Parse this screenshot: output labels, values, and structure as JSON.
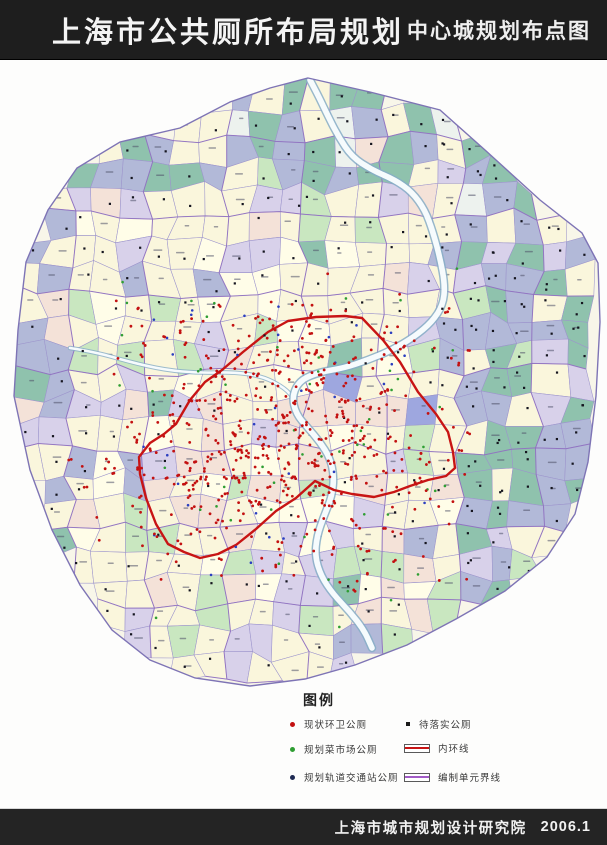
{
  "header": {
    "title": "上海市公共厕所布局规划",
    "subtitle": "中心城规划布点图"
  },
  "footer": {
    "credit": "上海市城市规划设计研究院",
    "date": "2006.1"
  },
  "legend": {
    "title": "图例",
    "items_left": [
      {
        "label": "现状环卫公厕",
        "color": "#C31111",
        "swatch": "dot"
      },
      {
        "label": "规划菜市场公厕",
        "color": "#2F9E33",
        "swatch": "dot"
      },
      {
        "label": "规划轨道交通站公厕",
        "color": "#1E2A52",
        "swatch": "dot"
      }
    ],
    "items_right": [
      {
        "label": "待落实公厕",
        "color": "#1A1A1A",
        "swatch": "square-dot"
      },
      {
        "label": "内环线",
        "color": "#C81414",
        "swatch": "line"
      },
      {
        "label": "编制单元界线",
        "color": "#A25BC6",
        "swatch": "line"
      }
    ]
  },
  "map": {
    "seed": 7,
    "palette": {
      "cream": "#FAF6DC",
      "cream2": "#FFFDE8",
      "pink": "#F4E2D8",
      "green": "#C9E7C0",
      "teal": "#8FC2AD",
      "bluegray": "#B2B9D8",
      "lavender": "#D8D1EA",
      "blue": "#9EA7DF",
      "pale": "#EDF2EE"
    },
    "line_colors": {
      "parcel": "#9C94CC",
      "unit": "#8F6FC0",
      "outline": "#7E74B5",
      "ring": "#C81414",
      "river_edge": "#86ADC7",
      "river_fill": "#F6FBFD",
      "dot_red": "#C31111",
      "dot_black": "#15151F",
      "dot_green": "#2F9E33",
      "dot_blue": "#2B3FC0"
    },
    "outline": [
      [
        308,
        78
      ],
      [
        370,
        92
      ],
      [
        440,
        110
      ],
      [
        485,
        150
      ],
      [
        540,
        200
      ],
      [
        582,
        233
      ],
      [
        598,
        263
      ],
      [
        600,
        322
      ],
      [
        596,
        396
      ],
      [
        588,
        462
      ],
      [
        575,
        514
      ],
      [
        547,
        557
      ],
      [
        505,
        591
      ],
      [
        456,
        619
      ],
      [
        407,
        645
      ],
      [
        355,
        665
      ],
      [
        305,
        679
      ],
      [
        250,
        686
      ],
      [
        195,
        678
      ],
      [
        150,
        660
      ],
      [
        112,
        630
      ],
      [
        80,
        585
      ],
      [
        52,
        530
      ],
      [
        30,
        470
      ],
      [
        14,
        396
      ],
      [
        18,
        330
      ],
      [
        26,
        262
      ],
      [
        48,
        210
      ],
      [
        77,
        168
      ],
      [
        120,
        142
      ],
      [
        180,
        128
      ],
      [
        230,
        102
      ],
      [
        270,
        88
      ]
    ],
    "ring": [
      [
        268,
        332
      ],
      [
        288,
        321
      ],
      [
        316,
        317
      ],
      [
        345,
        316
      ],
      [
        362,
        318
      ],
      [
        383,
        340
      ],
      [
        400,
        362
      ],
      [
        418,
        392
      ],
      [
        436,
        414
      ],
      [
        448,
        432
      ],
      [
        453,
        452
      ],
      [
        455,
        468
      ],
      [
        446,
        476
      ],
      [
        428,
        480
      ],
      [
        410,
        486
      ],
      [
        394,
        492
      ],
      [
        374,
        497
      ],
      [
        352,
        494
      ],
      [
        334,
        490
      ],
      [
        315,
        481
      ],
      [
        296,
        498
      ],
      [
        276,
        511
      ],
      [
        256,
        529
      ],
      [
        236,
        545
      ],
      [
        218,
        554
      ],
      [
        200,
        558
      ],
      [
        184,
        552
      ],
      [
        168,
        544
      ],
      [
        156,
        524
      ],
      [
        146,
        498
      ],
      [
        140,
        474
      ],
      [
        139,
        457
      ],
      [
        150,
        443
      ],
      [
        164,
        434
      ],
      [
        176,
        424
      ],
      [
        190,
        400
      ],
      [
        205,
        382
      ],
      [
        222,
        370
      ],
      [
        243,
        352
      ]
    ],
    "river": [
      [
        310,
        80
      ],
      [
        318,
        95
      ],
      [
        326,
        112
      ],
      [
        338,
        136
      ],
      [
        352,
        157
      ],
      [
        372,
        170
      ],
      [
        395,
        180
      ],
      [
        412,
        192
      ],
      [
        425,
        210
      ],
      [
        433,
        232
      ],
      [
        440,
        258
      ],
      [
        445,
        285
      ],
      [
        443,
        305
      ],
      [
        432,
        322
      ],
      [
        414,
        337
      ],
      [
        392,
        350
      ],
      [
        368,
        360
      ],
      [
        344,
        368
      ],
      [
        320,
        372
      ],
      [
        300,
        380
      ],
      [
        292,
        396
      ],
      [
        296,
        414
      ],
      [
        308,
        428
      ],
      [
        320,
        442
      ],
      [
        330,
        458
      ],
      [
        334,
        476
      ],
      [
        332,
        496
      ],
      [
        324,
        516
      ],
      [
        317,
        536
      ],
      [
        315,
        556
      ],
      [
        321,
        576
      ],
      [
        333,
        594
      ],
      [
        350,
        612
      ],
      [
        364,
        630
      ],
      [
        372,
        648
      ]
    ],
    "creek": [
      [
        70,
        348
      ],
      [
        95,
        352
      ],
      [
        130,
        362
      ],
      [
        165,
        370
      ],
      [
        200,
        373
      ],
      [
        232,
        372
      ],
      [
        262,
        376
      ],
      [
        285,
        388
      ],
      [
        295,
        400
      ]
    ],
    "red_clusters": [
      [
        295,
        425,
        75,
        55,
        45
      ],
      [
        225,
        470,
        55,
        45,
        25
      ],
      [
        350,
        470,
        60,
        45,
        15
      ],
      [
        300,
        350,
        70,
        30,
        15
      ]
    ],
    "dot_counts": {
      "red": 620,
      "green": 55,
      "blue": 35
    }
  }
}
